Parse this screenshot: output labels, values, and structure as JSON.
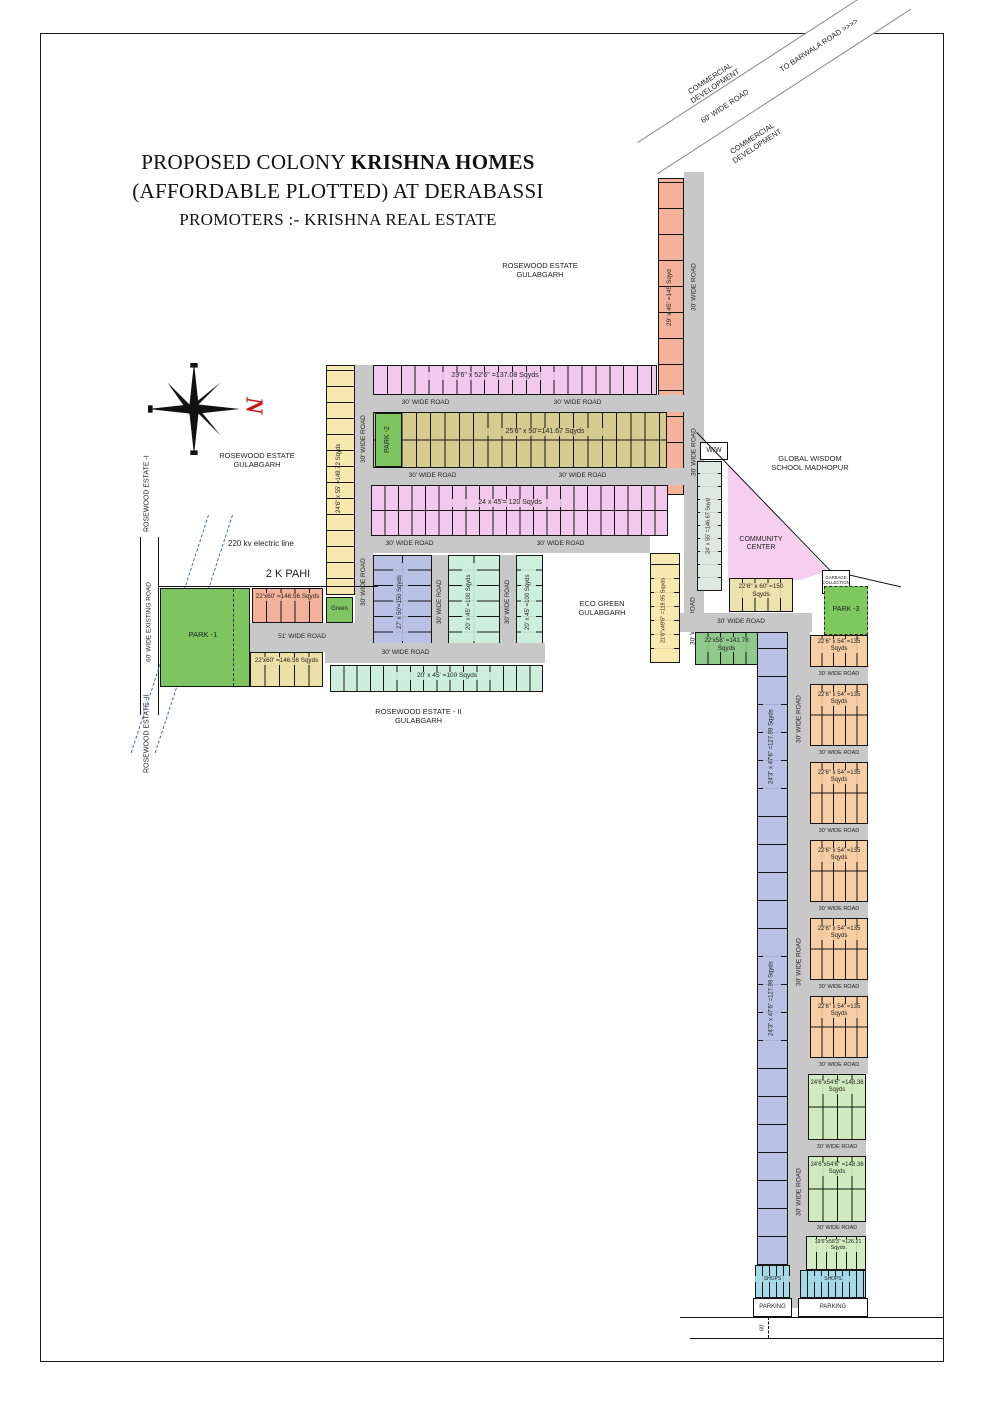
{
  "title": {
    "line1_normal": "PROPOSED COLONY ",
    "line1_bold": "KRISHNA HOMES",
    "line2": "(AFFORDABLE PLOTTED) AT DERABASSI",
    "promoters": "PROMOTERS :- KRISHNA REAL ESTATE"
  },
  "compass": {
    "north_letter": "N"
  },
  "roads": {
    "wide30": "30' WIDE ROAD",
    "wide51": "51' WIDE ROAD",
    "wide60": "60' WIDE ROAD",
    "existing60": "60' WIDE EXISTING ROAD",
    "to_barwala": "TO BARWALA ROAD >>>>",
    "dim60": "60'"
  },
  "areas": {
    "commercial": "COMMERCIAL DEVELOPMENT",
    "rosewood_estate": "ROSEWOOD ESTATE GULABGARH",
    "rosewood_1": "ROSEWOOD ESTATE -I",
    "rosewood_2": "ROSEWOOD ESTATE -II",
    "rosewood_2_full": "ROSEWOOD ESTATE - II GULABGARH",
    "eco_green": "ECO GREEN GULABGARH",
    "school": "GLOBAL WISDOM SCHOOL MADHOPUR",
    "community_center": "COMMUNITY CENTER",
    "park1": "PARK -1",
    "park2": "PARK -2",
    "park3": "PARK -3",
    "green": "Green",
    "ww": "W/W",
    "stp": "STP",
    "garbage": "GARBAGE COLLECTION",
    "pahi": "2 K PAHI",
    "electric": "220 kv electric line",
    "parking": "PARKING",
    "shops": "SHOPS"
  },
  "plots": {
    "p137": "23'6\" x 52'6\" =137.08 Sqyds",
    "p141": "25'6\" x 50'=141.67 Sqyds",
    "p120": "24 x 45'= 120 Sqyds",
    "p149": "24'6\" x 55' =149.72 Sqyds",
    "p150v": "27' x 50'=150 Sqyds",
    "p100": "20' x 45' =100 Sqyds",
    "p146": "22'x60' =146.56 Sqyds",
    "p145": "29' x 45' =145 Sqyd",
    "p146b": "24' x 55' =146.67 Sqyd",
    "p150": "22'6\" x 60' =150 Sqyds",
    "p141b": "22'x58' =141.78 Sqyds",
    "p119": "21'6\"x49'6\" =119.95 Sqyds",
    "p127": "24'3\" x 47'6\" =127.99 Sqyds",
    "p135": "22'6\" x 54' =135 Sqyds",
    "p148": "24'6\"x54'6\" =148.36 Sqyds",
    "p126": "19'6\"x58'3\" =126.21 Sqyds"
  },
  "colors": {
    "road_grey": "#c8c8c8",
    "pink": "#f2c8ee",
    "khaki": "#d6cc90",
    "pale_yellow": "#f7e9af",
    "salmon": "#f4b29a",
    "park_green": "#7dc561",
    "mint": "#cdeedd",
    "blue": "#b9c1e5",
    "orange": "#f7cda4",
    "light_green": "#cfeabf",
    "shop_blue": "#a5d9e8",
    "community_pink": "#f6cef0"
  }
}
